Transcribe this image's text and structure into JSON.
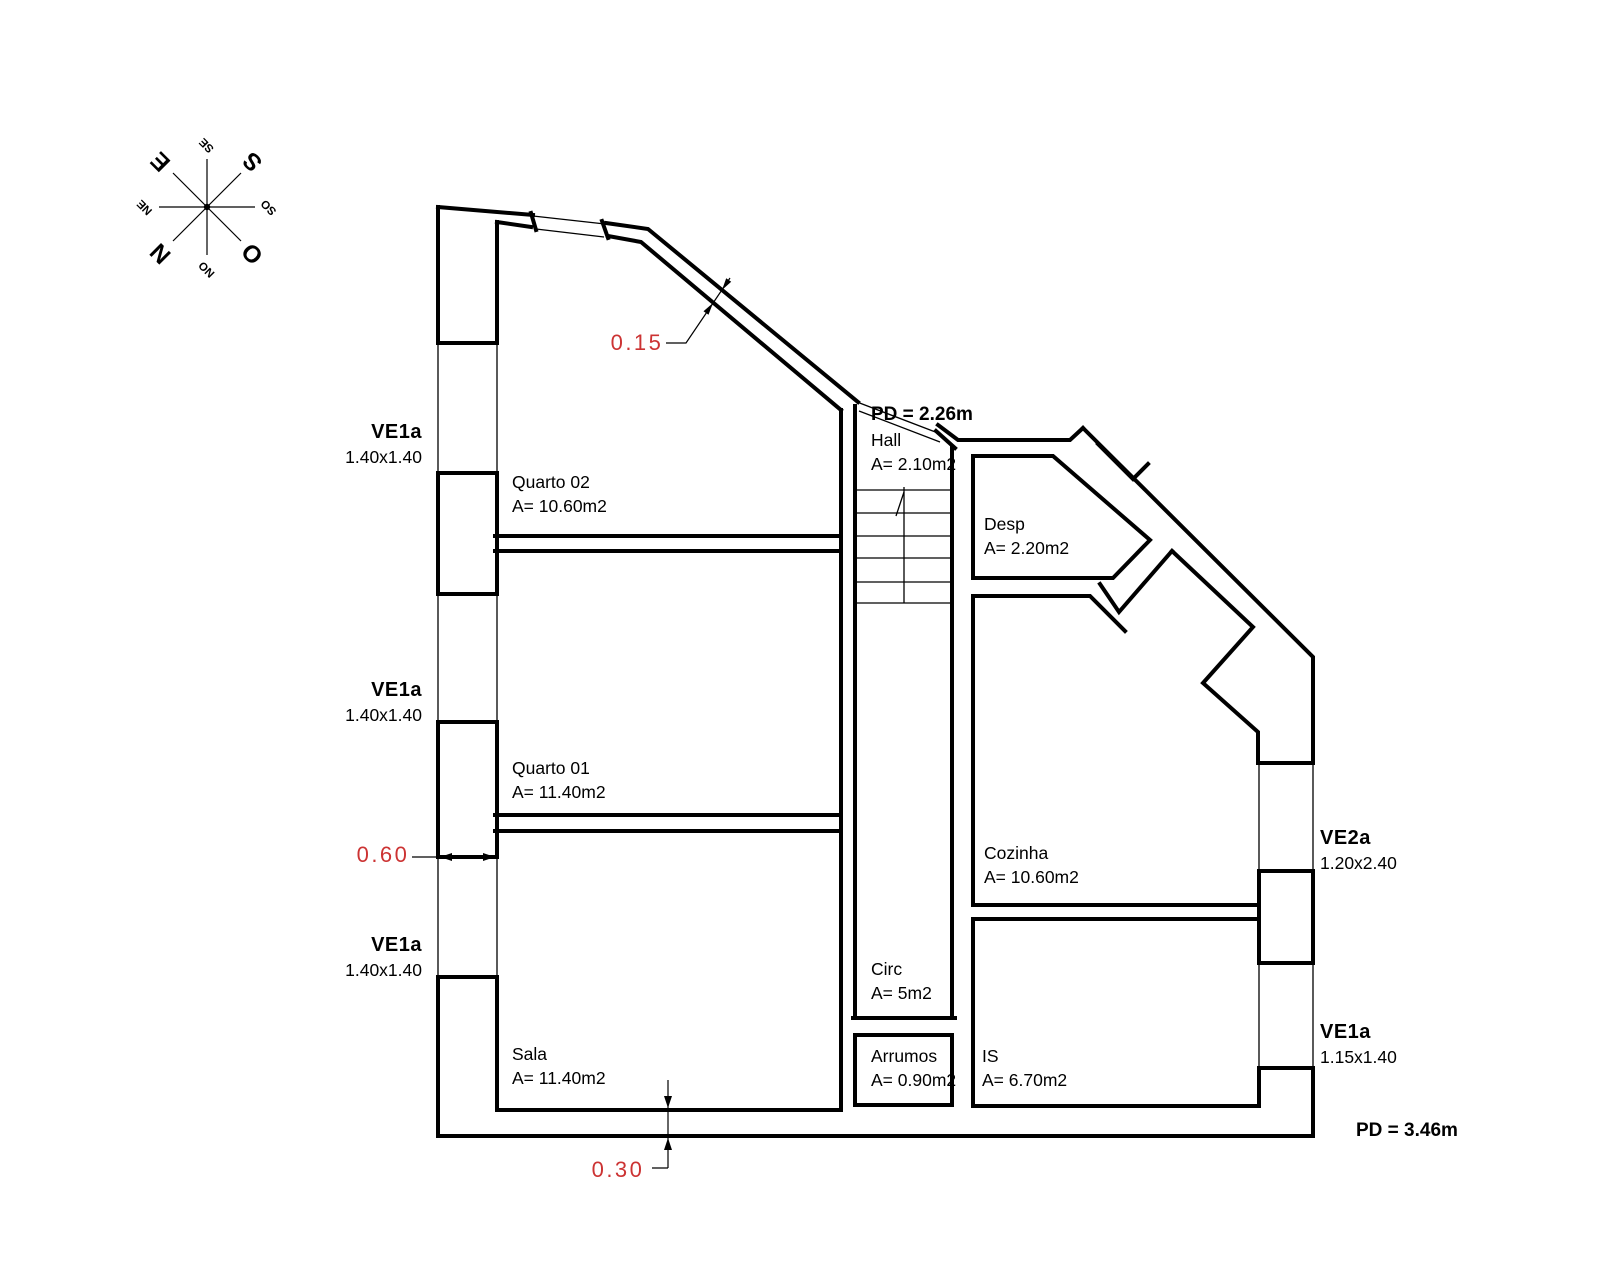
{
  "drawing": {
    "title": "floor-plan",
    "background": "#ffffff",
    "line_color": "#000000",
    "dim_color": "#cc3333",
    "compass_rotation_deg": 225
  },
  "compass": {
    "cardinal": [
      {
        "label": "N",
        "x": 161,
        "y": 253
      },
      {
        "label": "S",
        "x": 253,
        "y": 161
      },
      {
        "label": "E",
        "x": 161,
        "y": 161
      },
      {
        "label": "O",
        "x": 253,
        "y": 253
      }
    ],
    "intercardinal": [
      {
        "label": "NE",
        "x": 145,
        "y": 207
      },
      {
        "label": "SE",
        "x": 207,
        "y": 145
      },
      {
        "label": "SO",
        "x": 269,
        "y": 207
      },
      {
        "label": "NO",
        "x": 207,
        "y": 269
      }
    ]
  },
  "rooms": [
    {
      "name": "Quarto 02",
      "area": "A= 10.60m2",
      "x": 512,
      "y": 470
    },
    {
      "name": "Quarto 01",
      "area": "A= 11.40m2",
      "x": 512,
      "y": 756
    },
    {
      "name": "Sala",
      "area": "A= 11.40m2",
      "x": 512,
      "y": 1042
    },
    {
      "name": "Hall",
      "area": "A= 2.10m2",
      "x": 871,
      "y": 428
    },
    {
      "name": "Desp",
      "area": "A= 2.20m2",
      "x": 984,
      "y": 512
    },
    {
      "name": "Cozinha",
      "area": "A= 10.60m2",
      "x": 984,
      "y": 841
    },
    {
      "name": "Circ",
      "area": "A= 5m2",
      "x": 871,
      "y": 957
    },
    {
      "name": "Arrumos",
      "area": "A= 0.90m2",
      "x": 871,
      "y": 1044
    },
    {
      "name": "IS",
      "area": "A= 6.70m2",
      "x": 982,
      "y": 1044
    }
  ],
  "windows": [
    {
      "code": "VE1a",
      "size": "1.40x1.40",
      "x": 422,
      "y": 420,
      "align": "right"
    },
    {
      "code": "VE1a",
      "size": "1.40x1.40",
      "x": 422,
      "y": 678,
      "align": "right"
    },
    {
      "code": "VE1a",
      "size": "1.40x1.40",
      "x": 422,
      "y": 933,
      "align": "right"
    },
    {
      "code": "VE2a",
      "size": "1.20x2.40",
      "x": 1320,
      "y": 826,
      "align": "left"
    },
    {
      "code": "VE1a",
      "size": "1.15x1.40",
      "x": 1320,
      "y": 1020,
      "align": "left"
    }
  ],
  "ceiling_heights": [
    {
      "label": "PD = 2.26m",
      "x": 871,
      "y": 404
    },
    {
      "label": "PD = 3.46m",
      "x": 1356,
      "y": 1120
    }
  ],
  "dimensions": [
    {
      "value": "0.15",
      "x": 637,
      "y": 343
    },
    {
      "value": "0.60",
      "x": 383,
      "y": 855
    },
    {
      "value": "0.30",
      "x": 618,
      "y": 1170
    }
  ]
}
